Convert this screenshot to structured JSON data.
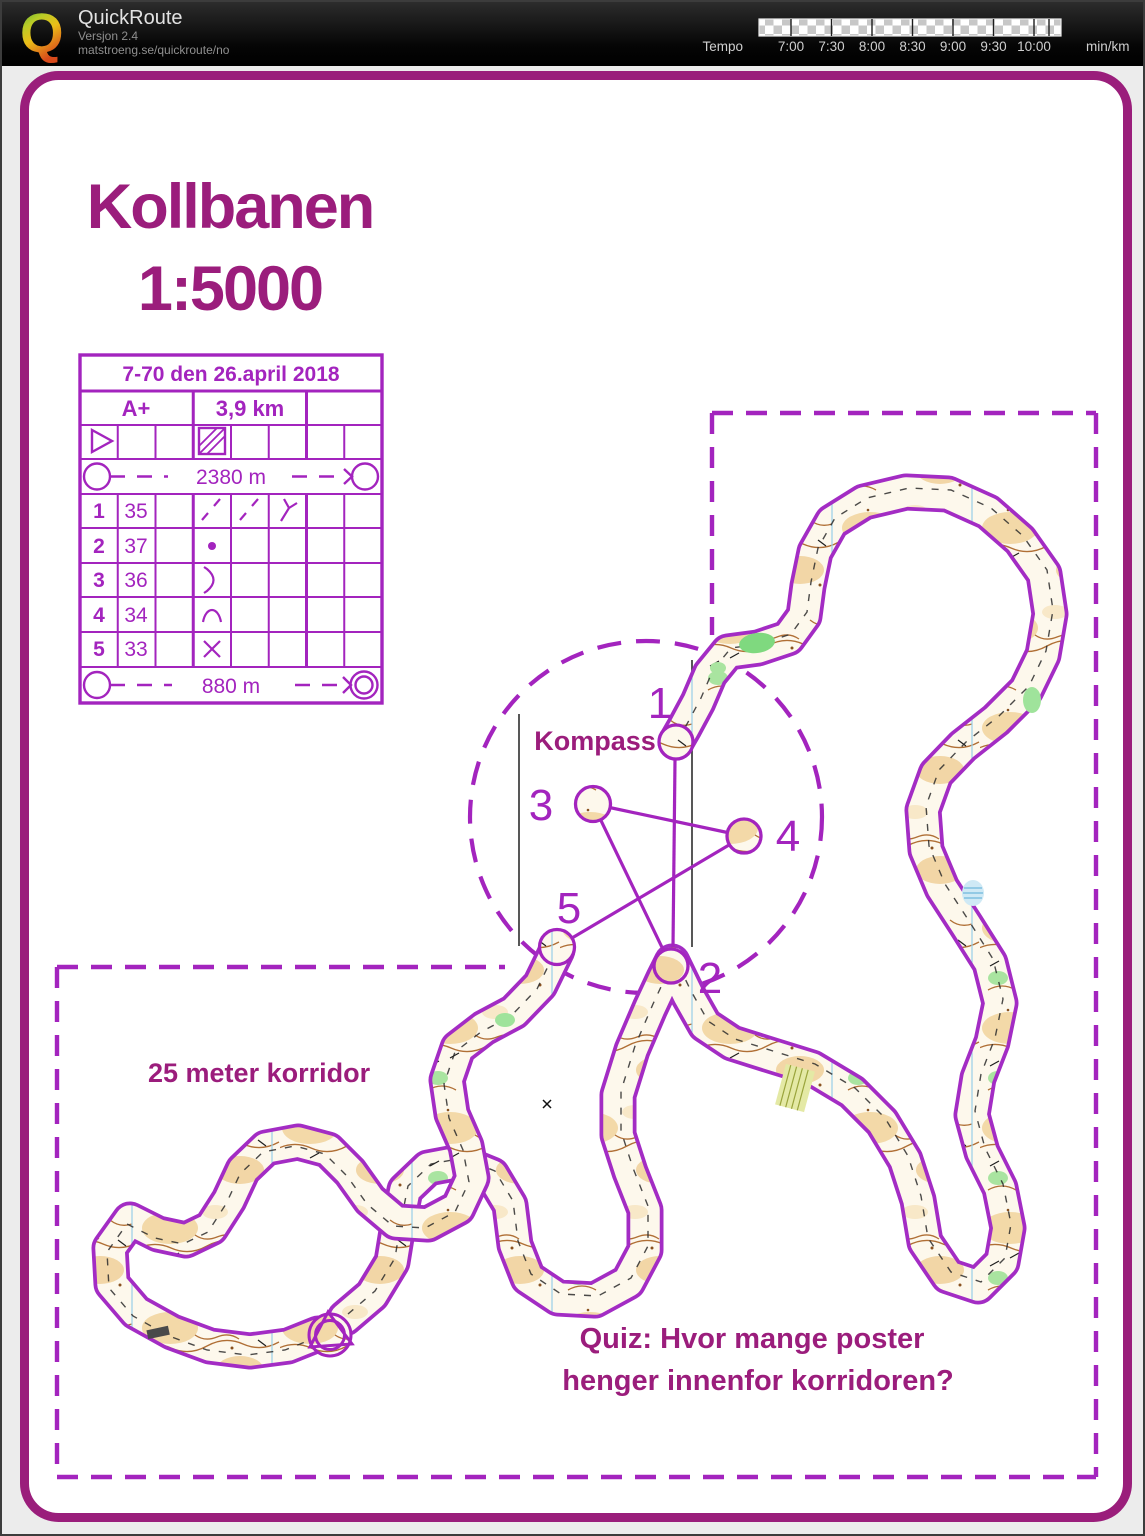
{
  "header": {
    "app_title": "QuickRoute",
    "version": "Versjon 2.4",
    "url": "matstroeng.se/quickroute/no",
    "logo_letter": "Q",
    "logo_icon": "quickroute-q-gradient",
    "tempo": {
      "label": "Tempo",
      "unit": "min/km",
      "ticks": [
        "7:00",
        "7:30",
        "8:00",
        "8:30",
        "9:00",
        "9:30",
        "10:00"
      ]
    }
  },
  "map": {
    "title_line1": "Kollbanen",
    "title_line2": "1:5000",
    "kompass_label": "Kompass",
    "corridor_label": "25 meter korridor",
    "quiz_line1": "Quiz: Hvor mange poster",
    "quiz_line2": "henger innenfor korridoren?",
    "controls": [
      {
        "number": "1"
      },
      {
        "number": "2"
      },
      {
        "number": "3"
      },
      {
        "number": "4"
      },
      {
        "number": "5"
      }
    ],
    "sheet": {
      "title": "7-70 den 26.april 2018",
      "course_class": "A+",
      "course_length": "3,9 km",
      "start_symbol": "start-triangle",
      "special_symbol": "hatched-square",
      "route1_length": "2380 m",
      "route2_length": "880 m",
      "rows": [
        {
          "no": "1",
          "code": "35",
          "symbols": [
            "slash-dash",
            "slash-dash",
            "y-junction"
          ]
        },
        {
          "no": "2",
          "code": "37",
          "symbols": [
            "dot"
          ]
        },
        {
          "no": "3",
          "code": "36",
          "symbols": [
            "crescent"
          ]
        },
        {
          "no": "4",
          "code": "34",
          "symbols": [
            "hill"
          ]
        },
        {
          "no": "5",
          "code": "33",
          "symbols": [
            "cross"
          ]
        }
      ]
    },
    "colors": {
      "course_purple": "#A324BE",
      "heading_magenta": "#9B1D7C",
      "page_border": "#9A1E7B"
    }
  }
}
